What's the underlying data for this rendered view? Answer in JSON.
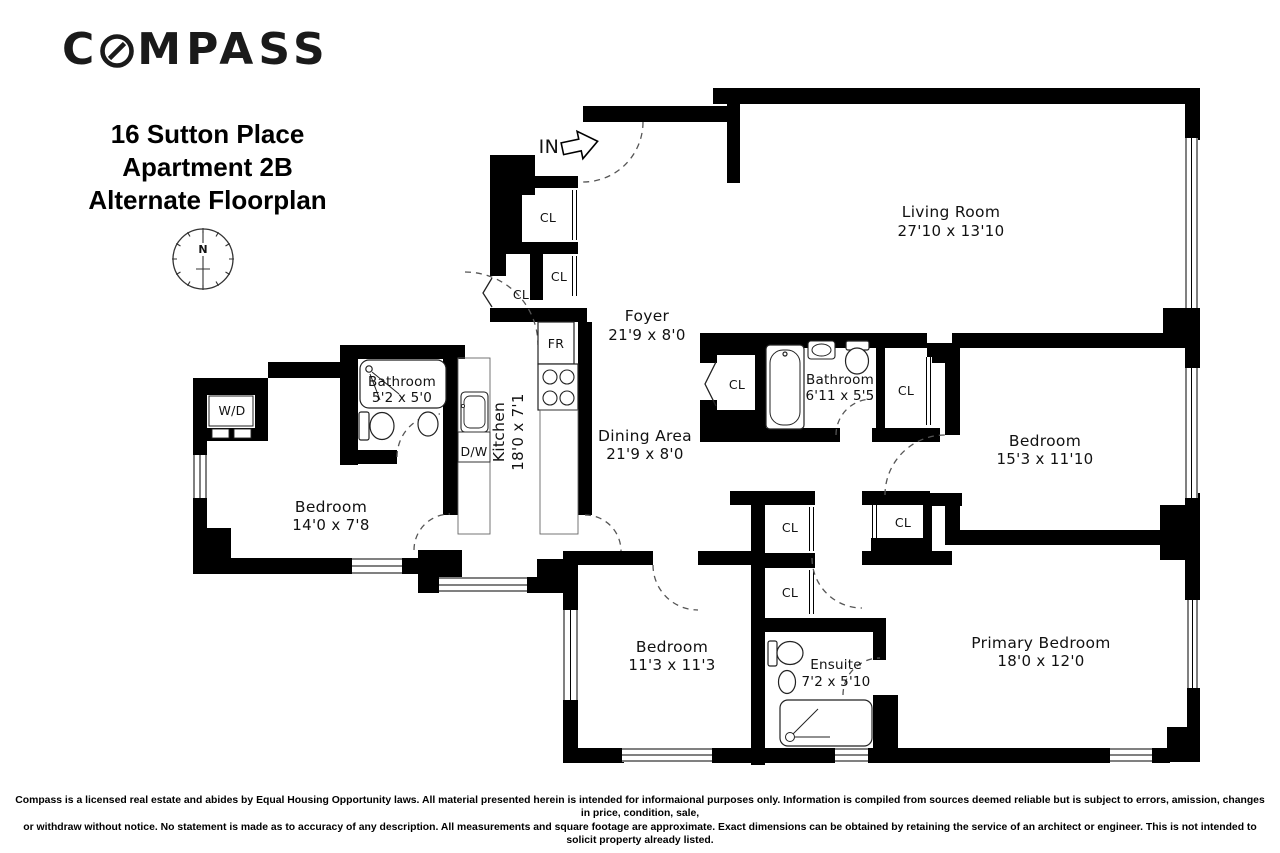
{
  "brand": {
    "logo_text": "COMPASS",
    "logo_left": "C",
    "logo_right": "MPASS"
  },
  "header": {
    "address_line1": "16 Sutton Place",
    "address_line2": "Apartment 2B",
    "address_line3": "Alternate Floorplan"
  },
  "compass_rose": {
    "north_label": "N"
  },
  "entry": {
    "label": "IN"
  },
  "rooms": {
    "living_room": {
      "name": "Living Room",
      "dims": "27'10 x 13'10"
    },
    "foyer": {
      "name": "Foyer",
      "dims": "21'9 x 8'0"
    },
    "dining_area": {
      "name": "Dining Area",
      "dims": "21'9 x 8'0"
    },
    "kitchen": {
      "name": "Kitchen",
      "dims": "18'0 x 7'1"
    },
    "bathroom_west": {
      "name": "Bathroom",
      "dims": "5'2 x 5'0"
    },
    "bedroom_west": {
      "name": "Bedroom",
      "dims": "14'0 x 7'8"
    },
    "bathroom_center": {
      "name": "Bathroom",
      "dims": "6'11 x 5'5"
    },
    "bedroom_east": {
      "name": "Bedroom",
      "dims": "15'3 x 11'10"
    },
    "bedroom_south": {
      "name": "Bedroom",
      "dims": "11'3 x 11'3"
    },
    "ensuite": {
      "name": "Ensuite",
      "dims": "7'2 x 5'10"
    },
    "primary_bedroom": {
      "name": "Primary Bedroom",
      "dims": "18'0 x 12'0"
    }
  },
  "labels": {
    "closet": "CL",
    "washer_dryer": "W/D",
    "dishwasher": "D/W",
    "refrigerator": "FR"
  },
  "footer": {
    "disclaimer_line1": "Compass is a licensed real estate and abides by Equal Housing Opportunity laws. All material presented herein is intended for informaional purposes only. Information is compiled from sources deemed reliable but is subject to errors, amission, changes in price, condition, sale,",
    "disclaimer_line2": "or withdraw without notice. No statement is made as to accuracy of any description. All measurements and square footage are approximate. Exact dimensions can be obtained by retaining the service of an architect or engineer. This is not intended to solicit property already listed."
  },
  "colors": {
    "wall": "#000000",
    "background": "#ffffff",
    "text": "#111111"
  }
}
